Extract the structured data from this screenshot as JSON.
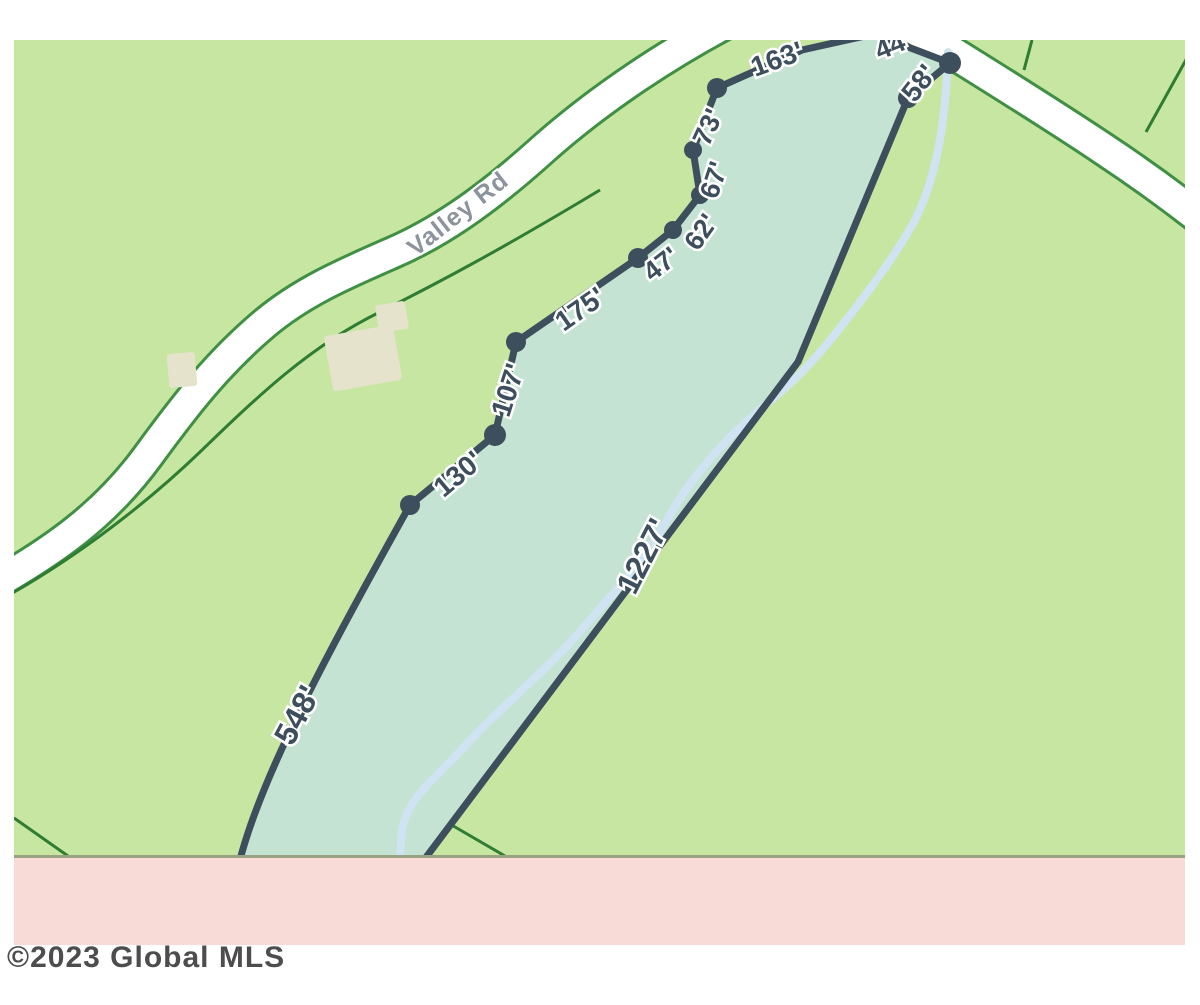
{
  "map": {
    "road_label": "Valley Rd",
    "boundary_labels": [
      {
        "id": "548",
        "text": "548'"
      },
      {
        "id": "130",
        "text": "130'"
      },
      {
        "id": "107",
        "text": "107'"
      },
      {
        "id": "175",
        "text": "175'"
      },
      {
        "id": "47",
        "text": "47'"
      },
      {
        "id": "62",
        "text": "62'"
      },
      {
        "id": "67",
        "text": "67'"
      },
      {
        "id": "73",
        "text": "73'"
      },
      {
        "id": "163",
        "text": "163'"
      },
      {
        "id": "44",
        "text": "44'"
      },
      {
        "id": "58",
        "text": "58'"
      },
      {
        "id": "1227",
        "text": "1227'"
      }
    ],
    "colors": {
      "land": "#c7e6a2",
      "parcel_fill": "#c4e3d3",
      "parcel_line": "#3d4e5c",
      "road_fill": "#ffffff",
      "road_edge": "#3f8f44",
      "property_line": "#2e7d33",
      "stream": "#d0e3f2",
      "building": "#e6e3cd",
      "bottom_band": "#f8dad6",
      "band_border": "#9ba281",
      "road_label_color": "#8d939c",
      "label_color": "#3d4e5c",
      "copyright_color": "#4d4d4d"
    }
  },
  "footer": {
    "copyright": "©2023 Global MLS"
  }
}
